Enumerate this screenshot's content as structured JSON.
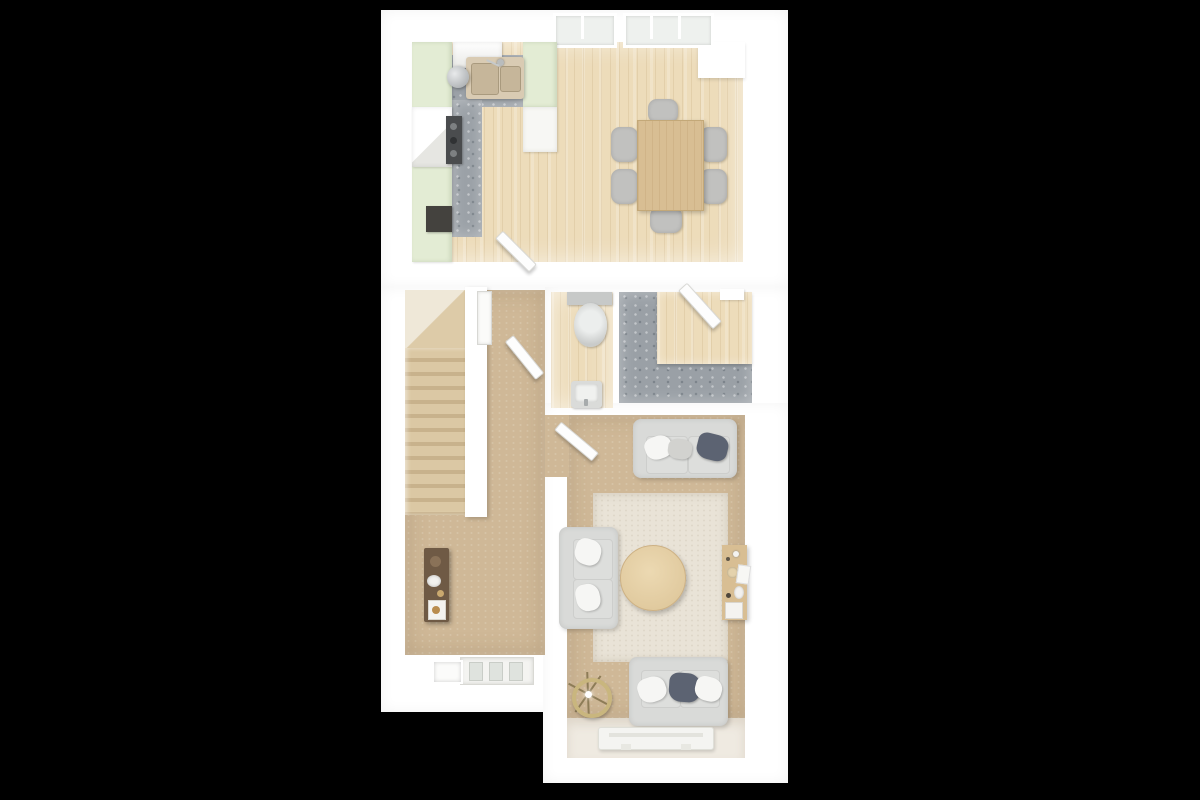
{
  "scene": {
    "kind": "3d-floor-plan-top-view",
    "floor_label": "ground-floor",
    "background": "#000000"
  },
  "palette": {
    "bg": "#000000",
    "wall": "#ffffff",
    "wood": "#eddcba",
    "stonegrey": "#9aa0a6",
    "carpet": "#cfb897",
    "palefloor": "#efeae1",
    "cabinet": "#e3ecd4",
    "counter": "#d9cbb3",
    "sofa": "#d9dad8",
    "slate": "#5c6372",
    "tablewood": "#d8be93",
    "darkwood": "#6f5a45",
    "rug": "#e9e3d7",
    "lampgold": "#c9b67e",
    "hob": "#4a4c4e"
  },
  "rooms": [
    {
      "id": "kitchen-dining",
      "floor": "light-oak",
      "features": [
        "sage-cabinets",
        "double-sink",
        "oven-hob",
        "cooker-hood",
        "dining-table",
        "six-chairs",
        "two-windows"
      ]
    },
    {
      "id": "hallway",
      "floor": "carpet",
      "features": [
        "console-table",
        "front-door",
        "sidelight"
      ]
    },
    {
      "id": "stairs",
      "floor": "carpet",
      "features": [
        "straight-flight"
      ]
    },
    {
      "id": "wc",
      "floor": "light-oak",
      "features": [
        "toilet",
        "basin"
      ]
    },
    {
      "id": "utility-room",
      "floor": "grey-stone",
      "features": [
        "l-shaped-worktop",
        "open-door"
      ]
    },
    {
      "id": "living-room",
      "floor": "carpet",
      "features": [
        "two-seat-sofa-top",
        "two-seat-sofa-left",
        "two-seat-sofa-bottom",
        "round-coffee-table",
        "area-rug",
        "floor-lamp",
        "console-table",
        "tv-bench"
      ]
    }
  ],
  "doors": [
    {
      "id": "door-hall-to-kitchen",
      "state": "open"
    },
    {
      "id": "door-hall-to-wc",
      "state": "open"
    },
    {
      "id": "door-hall-to-living",
      "state": "open"
    },
    {
      "id": "door-utility",
      "state": "open"
    },
    {
      "id": "front-door",
      "state": "closed"
    }
  ]
}
